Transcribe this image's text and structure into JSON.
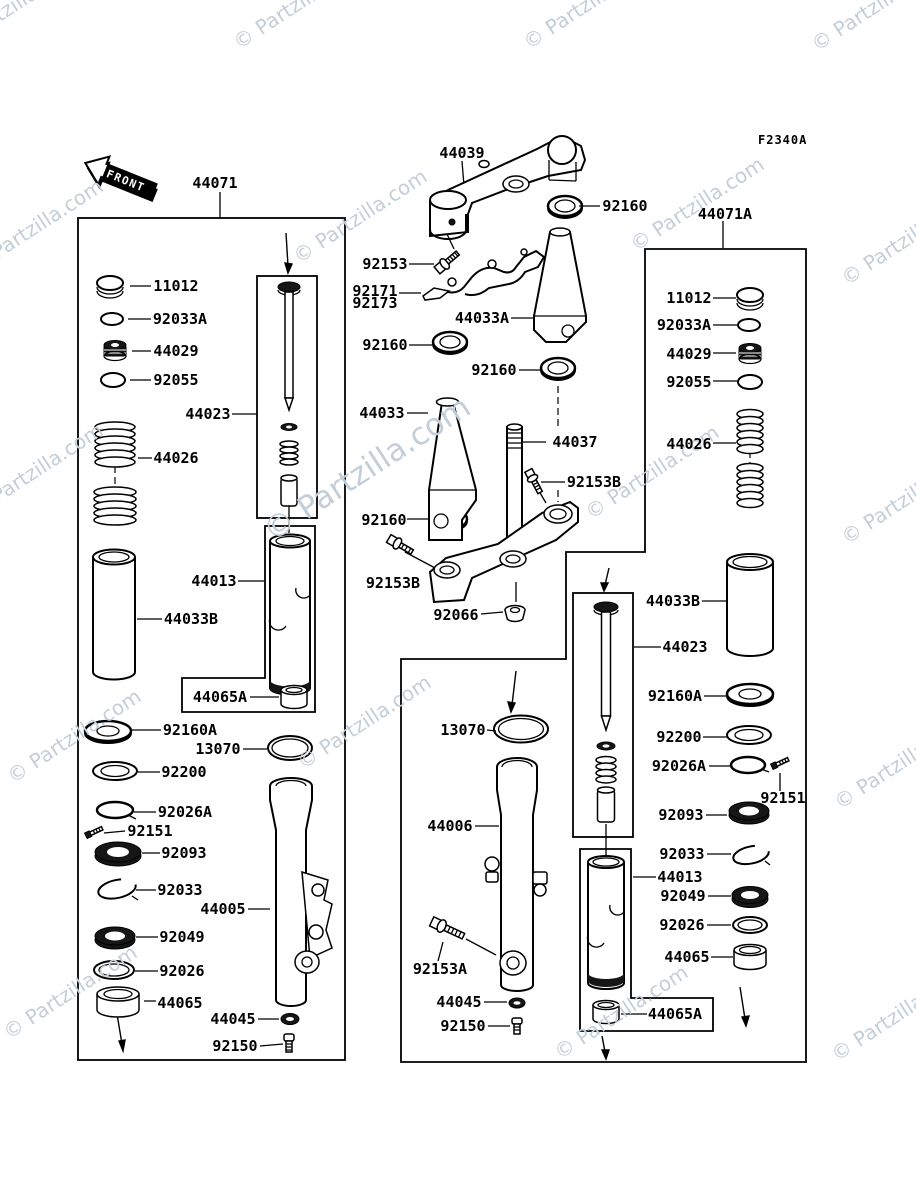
{
  "header": {
    "diagram_code": "F2340A"
  },
  "front_arrow": {
    "label": "FRONT"
  },
  "watermark": {
    "text": "© Partzilla.com",
    "color": "#c3ced8"
  },
  "assemblies": {
    "left_fork_box_label": "44071",
    "right_fork_box_label": "44071A"
  },
  "part_labels": [
    {
      "id": "44071",
      "text": "44071",
      "x": 215,
      "y": 183
    },
    {
      "id": "11012-L",
      "text": "11012",
      "x": 176,
      "y": 286
    },
    {
      "id": "92033A-L",
      "text": "92033A",
      "x": 180,
      "y": 319
    },
    {
      "id": "44029-L",
      "text": "44029",
      "x": 176,
      "y": 351
    },
    {
      "id": "92055-L",
      "text": "92055",
      "x": 176,
      "y": 380
    },
    {
      "id": "44023-L",
      "text": "44023",
      "x": 208,
      "y": 414
    },
    {
      "id": "44026-L",
      "text": "44026",
      "x": 176,
      "y": 458
    },
    {
      "id": "44013-L",
      "text": "44013",
      "x": 214,
      "y": 581
    },
    {
      "id": "44033B-L",
      "text": "44033B",
      "x": 191,
      "y": 619
    },
    {
      "id": "44065A-L",
      "text": "44065A",
      "x": 220,
      "y": 697
    },
    {
      "id": "92160A-L",
      "text": "92160A",
      "x": 190,
      "y": 730
    },
    {
      "id": "13070-L",
      "text": "13070",
      "x": 218,
      "y": 749
    },
    {
      "id": "92200-L",
      "text": "92200",
      "x": 184,
      "y": 772
    },
    {
      "id": "92026A-L",
      "text": "92026A",
      "x": 185,
      "y": 812
    },
    {
      "id": "92151-L",
      "text": "92151",
      "x": 150,
      "y": 831
    },
    {
      "id": "92093-L",
      "text": "92093",
      "x": 184,
      "y": 853
    },
    {
      "id": "92033-L",
      "text": "92033",
      "x": 180,
      "y": 890
    },
    {
      "id": "44005",
      "text": "44005",
      "x": 223,
      "y": 909
    },
    {
      "id": "92049-L",
      "text": "92049",
      "x": 182,
      "y": 937
    },
    {
      "id": "92026-L",
      "text": "92026",
      "x": 182,
      "y": 971
    },
    {
      "id": "44065-L",
      "text": "44065",
      "x": 180,
      "y": 1003
    },
    {
      "id": "44045-L",
      "text": "44045",
      "x": 233,
      "y": 1019
    },
    {
      "id": "92150-L",
      "text": "92150",
      "x": 235,
      "y": 1046
    },
    {
      "id": "44039",
      "text": "44039",
      "x": 462,
      "y": 153
    },
    {
      "id": "92160-T",
      "text": "92160",
      "x": 625,
      "y": 206
    },
    {
      "id": "92153",
      "text": "92153",
      "x": 385,
      "y": 264
    },
    {
      "id": "92171",
      "text": "92171",
      "x": 375,
      "y": 291
    },
    {
      "id": "92173",
      "text": "92173",
      "x": 375,
      "y": 303
    },
    {
      "id": "44033A",
      "text": "44033A",
      "x": 482,
      "y": 318
    },
    {
      "id": "92160-M1",
      "text": "92160",
      "x": 385,
      "y": 345
    },
    {
      "id": "92160-M2",
      "text": "92160",
      "x": 494,
      "y": 370
    },
    {
      "id": "44033",
      "text": "44033",
      "x": 382,
      "y": 413
    },
    {
      "id": "44037",
      "text": "44037",
      "x": 575,
      "y": 442
    },
    {
      "id": "92153B-1",
      "text": "92153B",
      "x": 594,
      "y": 482
    },
    {
      "id": "92160-M3",
      "text": "92160",
      "x": 384,
      "y": 520
    },
    {
      "id": "92153B-2",
      "text": "92153B",
      "x": 393,
      "y": 583
    },
    {
      "id": "92066",
      "text": "92066",
      "x": 456,
      "y": 615
    },
    {
      "id": "13070-M",
      "text": "13070",
      "x": 463,
      "y": 730
    },
    {
      "id": "44006",
      "text": "44006",
      "x": 450,
      "y": 826
    },
    {
      "id": "92153A",
      "text": "92153A",
      "x": 440,
      "y": 969
    },
    {
      "id": "44045-M",
      "text": "44045",
      "x": 459,
      "y": 1002
    },
    {
      "id": "92150-M",
      "text": "92150",
      "x": 463,
      "y": 1026
    },
    {
      "id": "44071A",
      "text": "44071A",
      "x": 725,
      "y": 214
    },
    {
      "id": "11012-R",
      "text": "11012",
      "x": 689,
      "y": 298
    },
    {
      "id": "92033A-R",
      "text": "92033A",
      "x": 684,
      "y": 325
    },
    {
      "id": "44029-R",
      "text": "44029",
      "x": 689,
      "y": 354
    },
    {
      "id": "92055-R",
      "text": "92055",
      "x": 689,
      "y": 382
    },
    {
      "id": "44026-R",
      "text": "44026",
      "x": 689,
      "y": 444
    },
    {
      "id": "44033B-R",
      "text": "44033B",
      "x": 673,
      "y": 601
    },
    {
      "id": "44023-R",
      "text": "44023",
      "x": 685,
      "y": 647
    },
    {
      "id": "92160A-R",
      "text": "92160A",
      "x": 675,
      "y": 696
    },
    {
      "id": "92200-R",
      "text": "92200",
      "x": 679,
      "y": 737
    },
    {
      "id": "92026A-R",
      "text": "92026A",
      "x": 679,
      "y": 766
    },
    {
      "id": "92151-R",
      "text": "92151",
      "x": 783,
      "y": 798
    },
    {
      "id": "92093-R",
      "text": "92093",
      "x": 681,
      "y": 815
    },
    {
      "id": "92033-R",
      "text": "92033",
      "x": 682,
      "y": 854
    },
    {
      "id": "44013-R",
      "text": "44013",
      "x": 680,
      "y": 877
    },
    {
      "id": "92049-R",
      "text": "92049",
      "x": 683,
      "y": 896
    },
    {
      "id": "92026-R",
      "text": "92026",
      "x": 682,
      "y": 925
    },
    {
      "id": "44065-R",
      "text": "44065",
      "x": 687,
      "y": 957
    },
    {
      "id": "44065A-R",
      "text": "44065A",
      "x": 675,
      "y": 1014
    }
  ]
}
